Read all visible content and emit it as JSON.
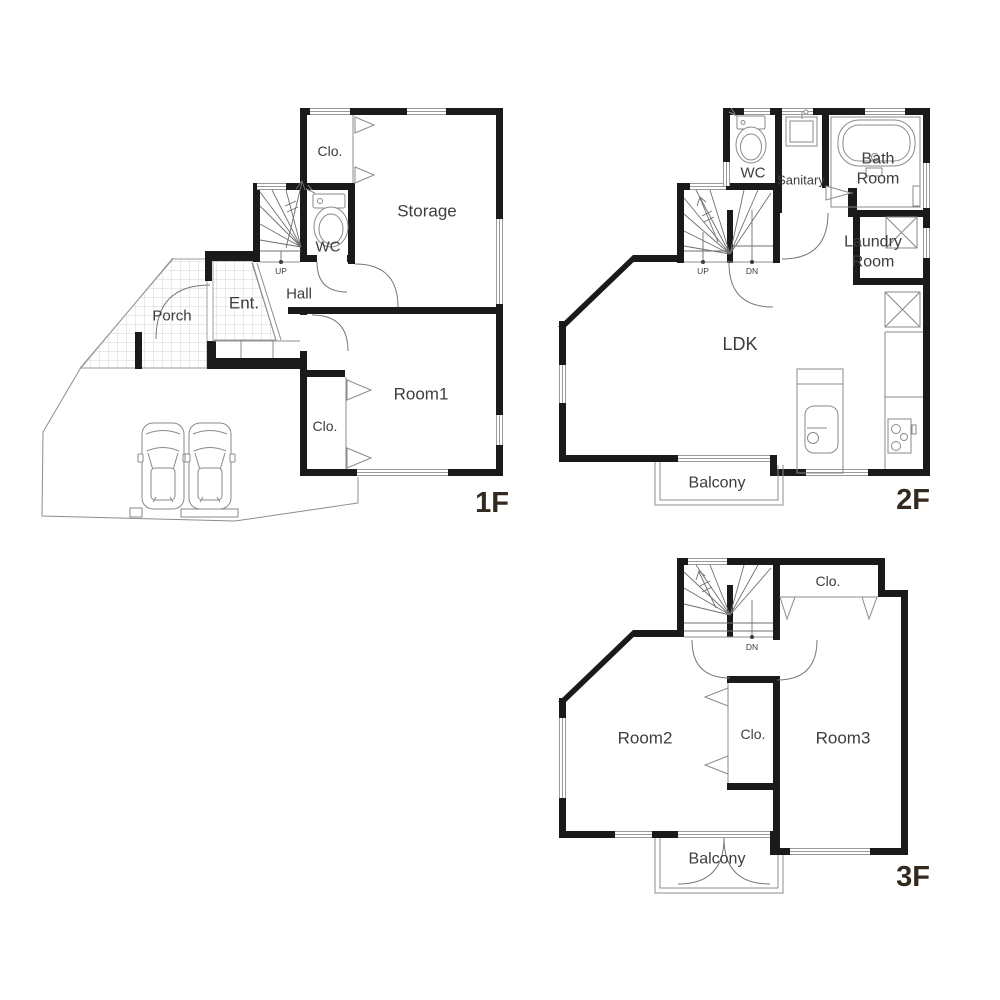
{
  "document_title": "3-story house floor plan",
  "colors": {
    "wall": "#1a1a1a",
    "thin_line": "#8c8c8c",
    "fixture_line": "#8a8a8a",
    "label_text": "#3d3d3d",
    "floor_label_text": "#33291f",
    "background": "#ffffff"
  },
  "floor_1f": {
    "floor_label": "1F",
    "closet_top": "Clo.",
    "storage": "Storage",
    "wc": "WC",
    "stairs_up": "UP",
    "hall": "Hall",
    "entrance": "Ent.",
    "porch": "Porch",
    "room1": "Room1",
    "closet_room1": "Clo."
  },
  "floor_2f": {
    "floor_label": "2F",
    "wc": "WC",
    "sanitary": "Sanitary",
    "bath_line1": "Bath",
    "bath_line2": "Room",
    "laundry_line1": "Laundry",
    "laundry_line2": "Room",
    "stairs_up": "UP",
    "stairs_down": "DN",
    "ldk": "LDK",
    "balcony": "Balcony"
  },
  "floor_3f": {
    "floor_label": "3F",
    "closet_top": "Clo.",
    "room2": "Room2",
    "closet_mid": "Clo.",
    "room3": "Room3",
    "stairs_down": "DN",
    "balcony": "Balcony"
  }
}
